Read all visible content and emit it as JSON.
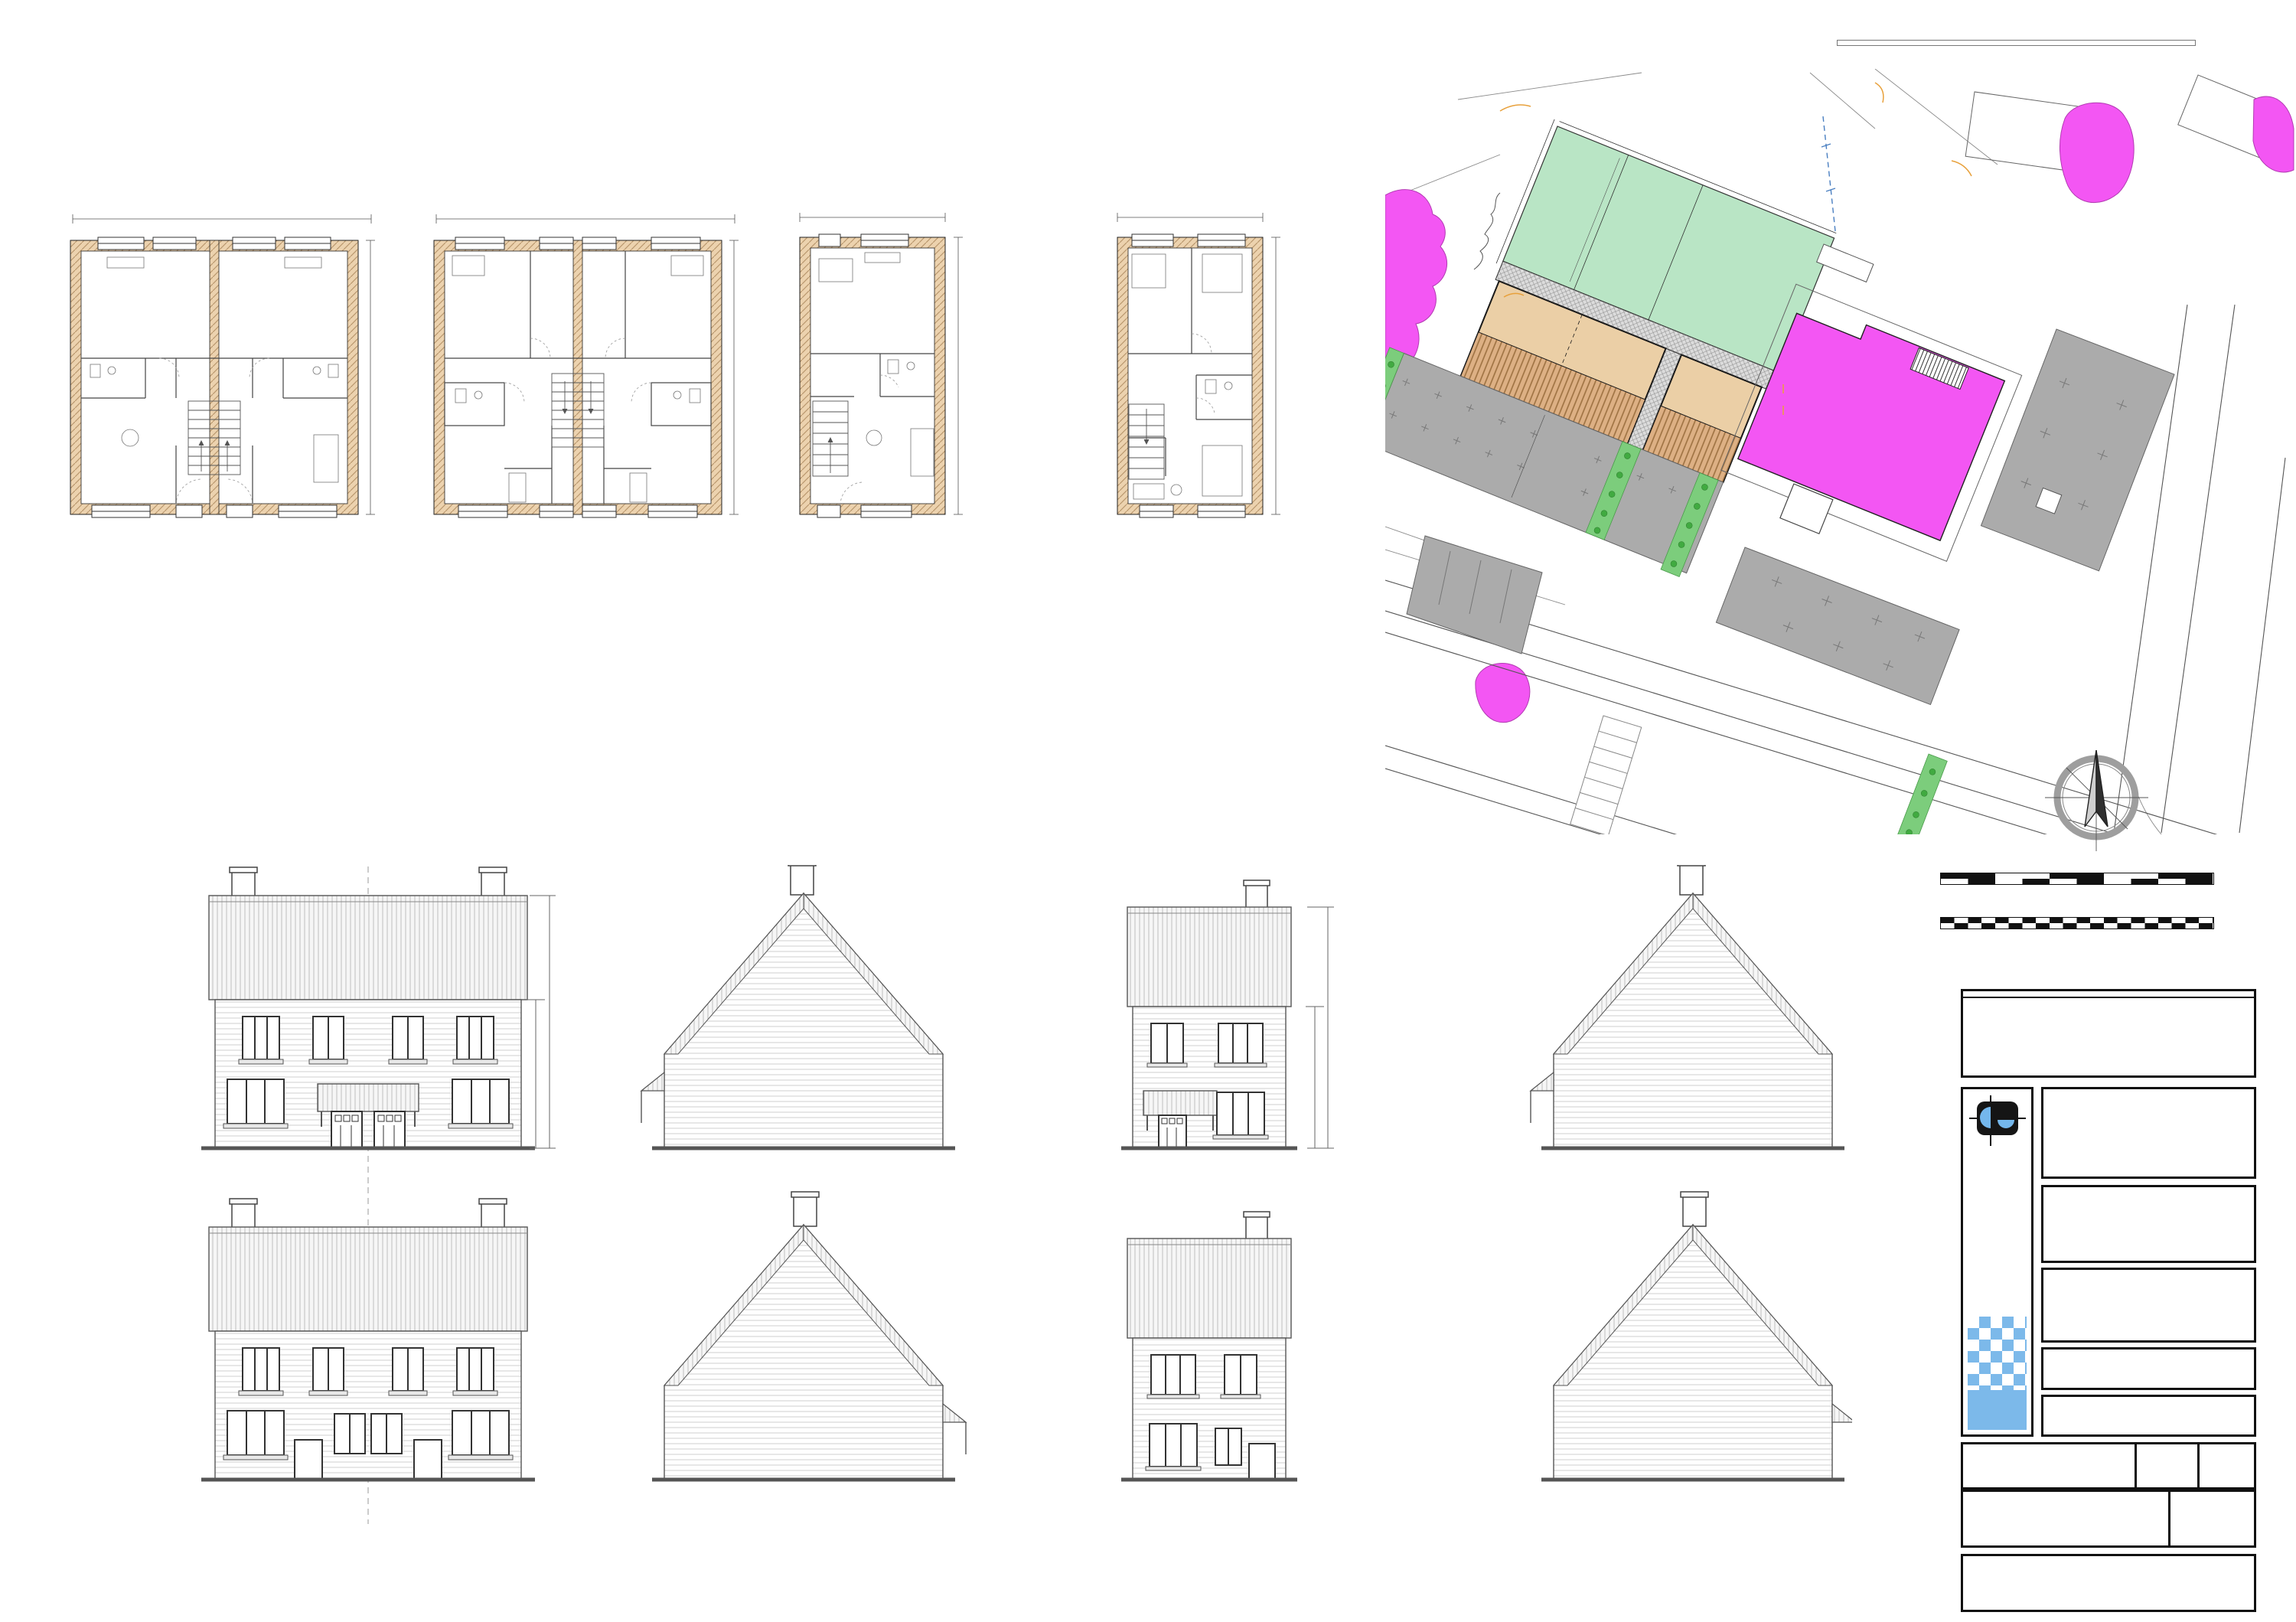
{
  "copyright": {
    "line1": "© Crown Copyright. All rights reserved. License no. 100019980",
    "line2": "Obtained from www.centremapslive.com"
  },
  "site": {
    "title": "PROPOSED SITE PLAN",
    "scale": "SCALE 1:200",
    "garden": "Garden",
    "plot1": "Plot 1",
    "plot2": "Plot 2",
    "plot3": "Plot 3",
    "parking": "Parking",
    "armstrong": "ARMSTRONG ROAD",
    "kaye": "KAYE ROAD",
    "existing_kerb": "existing\ndropped\nkerb access\nwidened",
    "new_kerb": "new\ndropped\nkerb access",
    "smoking": "smoking\nshelter\nremoved",
    "close_kerb": "close\ndropped\nkerb access",
    "dim_a": "10080",
    "dim_b": "5585",
    "bays": [
      "1",
      "1",
      "2",
      "2",
      "3",
      "3"
    ],
    "colors": {
      "garden": "#b9e5c5",
      "plot": "#ebcfa6",
      "magenta": "#f356f3",
      "parking": "#ababab",
      "verge": "#7ccd7c"
    }
  },
  "plans": [
    {
      "title": "PROPOSED GROUND FLOOR",
      "suffix": "- plot 1&2",
      "scale": "SCALE 1:100",
      "dim_w": "10565 [34'-8\"]",
      "dim_h": "10115 [33'-2\"]",
      "rooms": {
        "kitchen": "Kitchen / Dining",
        "wc": "WC",
        "store": "Store",
        "living": "Living Room",
        "hall": "Hall"
      }
    },
    {
      "title": "PROPOSED FIRST FLOOR",
      "suffix": "- plot 1&2",
      "scale": "SCALE 1:100",
      "dim_w": "10565 [34'-8\"]",
      "dim_h": "10115 [33'-2\"]",
      "rooms": {
        "bed1": "Bedroom One",
        "bed2": "Bedroom Two",
        "bed3": "Bedroom Three",
        "store": "Store",
        "ensuite": "En Suite",
        "landing": "Landing",
        "bath": "Bathroom",
        "bulkhead": "Bulkhead\nCup'd",
        "down": "down"
      }
    },
    {
      "title": "PROPOSED GROUND FLOOR",
      "suffix": "- plot 3",
      "scale": "SCALE 1:100",
      "dim_w": "5503 [18'-1\"]",
      "dim_h": "10115 [33'-2\"]",
      "rooms": {
        "kitchen": "Kitchen / Dining",
        "wc": "WC",
        "store": "Store",
        "living": "Living Room",
        "hall": "Hall"
      }
    },
    {
      "title": "PROPOSED FIRST FLOOR",
      "suffix": "- plot 3",
      "scale": "SCALE 1:100",
      "dim_w": "5503 [18'-1\"]",
      "dim_h": "10115 [33'-2\"]",
      "rooms": {
        "bed1": "Bedroom One",
        "bed2": "Bedroom Two",
        "bed3": "Bedroom Three",
        "store": "Store",
        "ensuite": "En Suite",
        "landing": "Landing",
        "bath": "Bathroom",
        "bulkhead": "Bulkhead\nCup'd",
        "down": "down"
      }
    }
  ],
  "elevations": [
    {
      "title": "PROPOSED FRONT ELEVATION",
      "suffix": "- plot 1&2",
      "scale": "SCALE 1:100",
      "dim_total": "8611",
      "dim_wall": "4950"
    },
    {
      "title": "PROPOSED SIDE ELEVATION",
      "suffix": "- plot 1&2",
      "scale": "SCALE 1:100"
    },
    {
      "title": "PROPOSED FRONT ELEVATION",
      "suffix": "- plot 3",
      "scale": "SCALE 1:100",
      "dim_total": "8611",
      "dim_wall": "4950"
    },
    {
      "title": "PROPOSED SIDE ELEVATION",
      "suffix": "- plot 3",
      "scale": "SCALE 1:100"
    },
    {
      "title": "PROPOSED REAR ELEVATION",
      "suffix": "- plot 1&2",
      "scale": "SCALE 1:100"
    },
    {
      "title": "PROPOSED SIDE ELEVATION",
      "suffix": "- plot 1&2",
      "scale": "SCALE 1:100"
    },
    {
      "title": "PROPOSED REAR ELEVATION",
      "suffix": "- plot 3",
      "scale": "SCALE 1:100"
    },
    {
      "title": "PROPOSED SIDE ELEVATION",
      "suffix": "- plot 3",
      "scale": "SCALE 1:100"
    }
  ],
  "scalebar": {
    "s50": "1:50",
    "s100": "1:100",
    "s200": "1:200",
    "s500": "1:500",
    "top1": [
      "1m",
      "2m",
      "3m",
      "4m",
      "5m"
    ],
    "bot1": [
      "2m",
      "4m",
      "6m",
      "8m",
      "10m"
    ],
    "top2": [
      "5m",
      "10m",
      "15m",
      "20m"
    ],
    "bot2": [
      "10m",
      "20m",
      "30m",
      "40m",
      "50m"
    ]
  },
  "north": "N",
  "tb": {
    "revisions": "REVISIONS",
    "rev_dot": ".",
    "brand": "PAUL GAUGHAN",
    "brand_sub": "BUILDING CONSULTANTS",
    "addr1": "Unit E14, Langham Park Industrial Estate, Lows Lane",
    "addr2": "Stanton by Dale, Ilkeston DE7 4RJ",
    "phone": "Phone 0115 9324010",
    "email": "E-mail: info@paul-gaughan.co.uk",
    "web": "Web: www.paul-gaughan.co.uk",
    "client_h": "CLIENT",
    "location_h": "LOCATION",
    "location": "Land Adjacent to:\nThe Local Inn, Armstrong Road, Mansfield,\nNottinghamshire, NG9 6JR",
    "project_h": "PROJECT",
    "project": "Proposed Residential Development",
    "title_h": "TITLE",
    "title": "Proposed Floor Plans, Elevations & Site Plan",
    "paper_h": "PAPER SIZE",
    "paper": "ISO A1 (594.00 x 841.00 MM)",
    "scale_h": "SCALE",
    "scale": "1:100; 1:200",
    "date_h": "DATE",
    "date": "Sept\n2024",
    "dwg_h": "DRAWING NUMBER",
    "dwg": "DB/BC/24/32/02",
    "rev_h": "REVISION",
    "rev": ".",
    "note": "Scales are correct at time of plotting however please note that distortion can occur during copying. This drawing is copyright and may not be altered, traced, photographed, electronically copied or used for any purpose other than for which it is issued, without written permission from Mr. Gaughan.\nCheck all dimensions on site. Any discrepancies should be reported to the designer before works proceed. Hatching is a representation of materials only."
  }
}
